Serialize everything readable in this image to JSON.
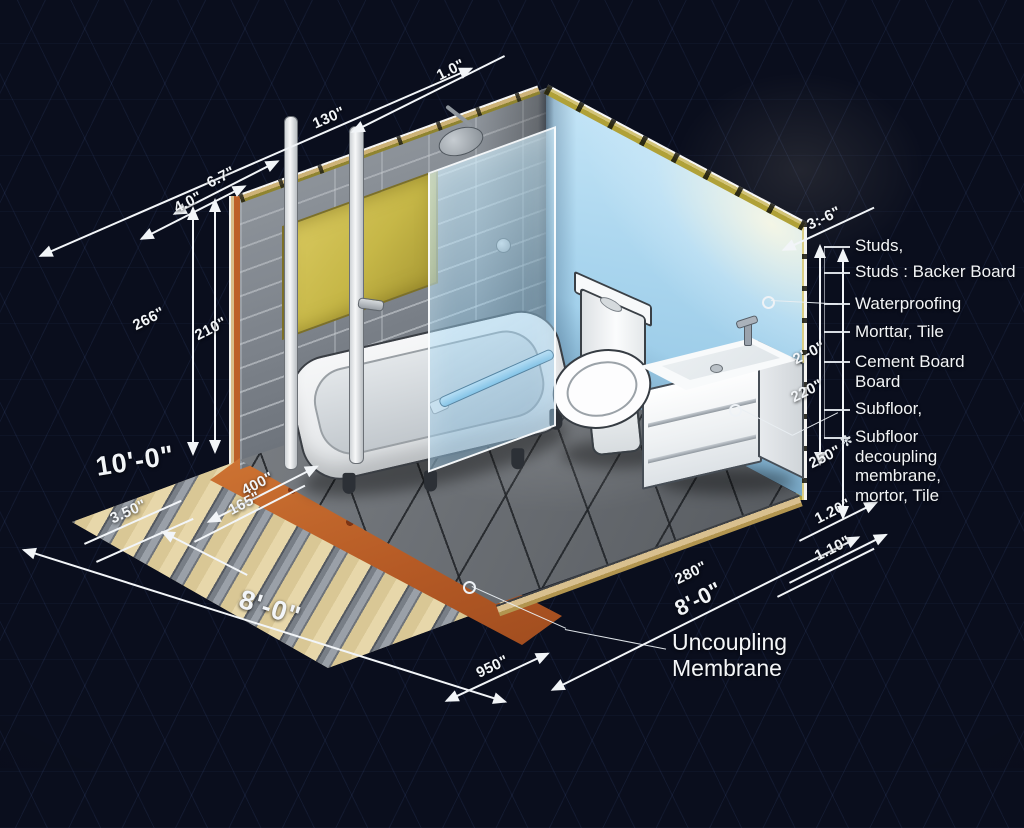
{
  "diagram_title": "Isometric bathroom cutaway construction diagram",
  "colors": {
    "background": "#0a0e1d",
    "wall_blue": "#aadcf5",
    "tile_gray": "#858b92",
    "membrane_orange": "#bb5f28",
    "waterproofing_yellow": "#cdbf52",
    "subfloor_tan": "#d9c795",
    "dimension_white": "#f2f5f8"
  },
  "icons": {
    "sketch_mark": "✻"
  },
  "dimensions": {
    "d_top": "1.0\"",
    "d_wall_top": "130\"",
    "d_67": "6.7\"",
    "d_40": "4.0\"",
    "d_266": "266\"",
    "d_210": "210\"",
    "d_400": "400\"",
    "d_165": "165\"",
    "d_10ft": "10'-0\"",
    "d_350": "3.50\"",
    "d_8ft_left": "8'-0\"",
    "d_950": "950\"",
    "d_280": "280\"",
    "d_8ft_right": "8'-0\"",
    "d_110": "1.10\"",
    "d_120": "1.20\"",
    "d_36": "3:-6\"",
    "d_2ft": "2'-0\"",
    "d_220": "220\"",
    "d_250": "250\""
  },
  "right_labels": {
    "items": [
      {
        "text": "Studs,"
      },
      {
        "text": "Studs : Backer Board"
      },
      {
        "text": "Waterproofing"
      },
      {
        "text": "Morttar, Tile"
      },
      {
        "text": "Cement Board\nBoard"
      },
      {
        "text": "Subfloor,"
      },
      {
        "text": "Subfloor\ndecoupling\nmembrane,\nmortor, Tile"
      }
    ]
  },
  "callout": {
    "uncoupling": "Uncoupling\nMembrane"
  }
}
